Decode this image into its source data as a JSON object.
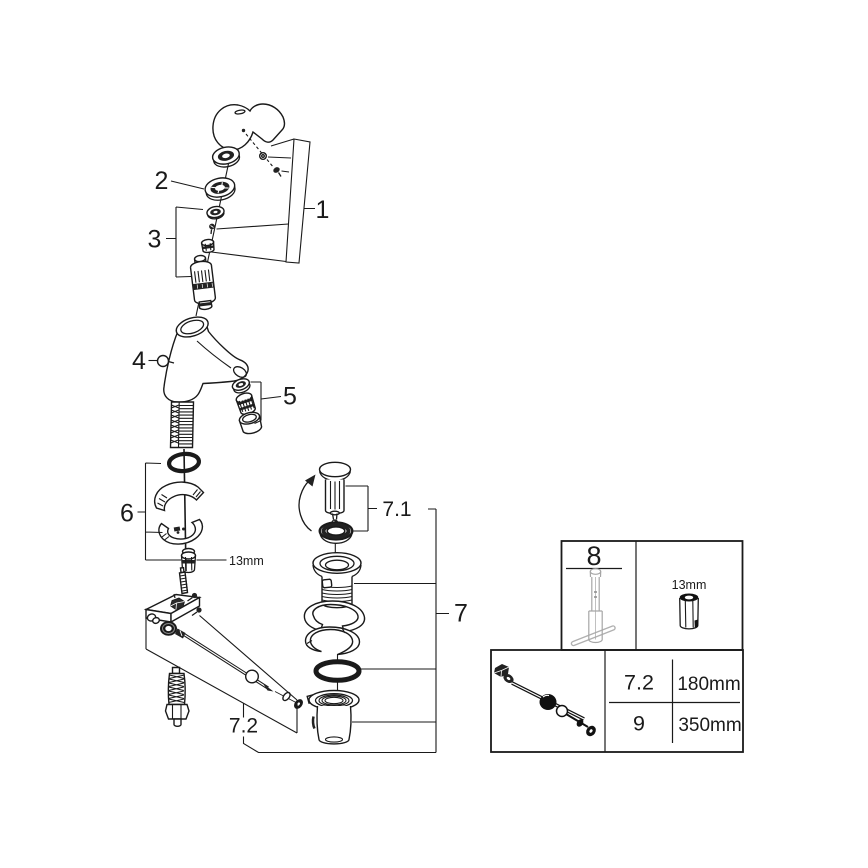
{
  "diagram": {
    "callouts": {
      "c1": "1",
      "c2": "2",
      "c3": "3",
      "c4": "4",
      "c5": "5",
      "c6": "6",
      "c7": "7",
      "c7_1": "7.1",
      "c7_2": "7.2",
      "wrench_size": "13mm"
    }
  },
  "tables": {
    "tool": {
      "part_no": "8",
      "socket_size": "13mm"
    },
    "rods": {
      "rows": [
        {
          "part_no": "7.2",
          "length": "180mm"
        },
        {
          "part_no": "9",
          "length": "350mm"
        }
      ]
    }
  },
  "colors": {
    "line": "#1a1a1a",
    "tool_gray": "#a6a6a6",
    "background": "#ffffff"
  }
}
